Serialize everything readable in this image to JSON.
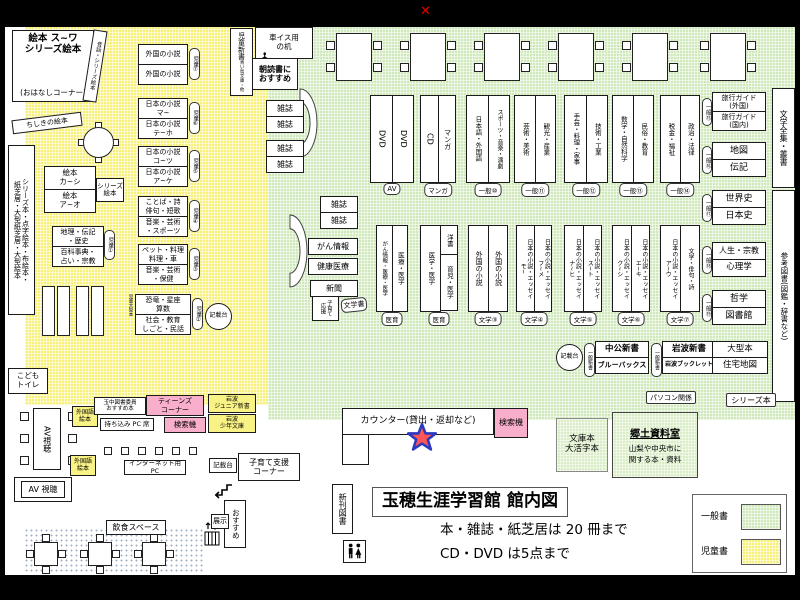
{
  "chrome": {
    "close_mark": "✕"
  },
  "labels": {
    "kisaidai": "記載台",
    "kensakuki": "検索機",
    "zasshi": "雑誌"
  },
  "children_area": {
    "story_room_line1": "絵本 ス~ワ",
    "story_room_line2": "シリーズ絵本",
    "story_room_line3": "(おはなしコーナー)",
    "mukashi_shelf": "昔話・シリーズ絵本",
    "chishiki_shelf": "ちしきの絵本",
    "left_shelf": "シリーズ本・点字絵本・布絵本・\n紙芝居・大型紙芝居・大型絵本",
    "ehon_top": "絵本\nカ~シ",
    "ehon_bottom": "絵本\nア~オ",
    "ehon_series": "シリーズ\n絵本",
    "geo_top": "地理・伝記\n・歴史",
    "geo_bottom": "百科事典・\n占い・宗教",
    "geo_tag": "児童①",
    "side_label": "児童大型本",
    "jido_shinsho": "児童新書",
    "jido_shinsho_sub": "青い鳥文庫・他",
    "asadoku": "朝読書に\nおすすめ",
    "toilet": "こども\nトイレ",
    "shelves": [
      {
        "top": "外国の小説",
        "bottom": "外国の小説",
        "tag": "児童⑦"
      },
      {
        "top": "日本の小説\nマ~",
        "bottom": "日本の小説\nテ~ホ",
        "tag": "児童⑥"
      },
      {
        "top": "日本の小説\nコ~ツ",
        "bottom": "日本の小説\nア~ケ",
        "tag": "児童⑤"
      },
      {
        "top": "ことば・詩\n俳句・短歌",
        "bottom": "音楽・芸術\n・スポーツ",
        "tag": "児童④"
      },
      {
        "top": "ペット・料理\n料理・車",
        "bottom": "音楽・芸術\n・保健",
        "tag": "児童③"
      },
      {
        "top": "恐竜・星座\n算数",
        "bottom": "社会・教育\nしごと・民話",
        "tag": "児童②"
      }
    ]
  },
  "general_area": {
    "wheelchair_desk": "車イス用\nの机",
    "gan": "がん情報",
    "kenko": "健康医療",
    "shinbun": "新聞",
    "kosodate": "子育て\n応援",
    "bungakusho_tag": "文学書",
    "row1": [
      {
        "cols": [
          "DVD",
          "DVD"
        ],
        "tag": "AV"
      },
      {
        "cols": [
          "CD",
          "マンガ"
        ],
        "tag": "マンガ"
      },
      {
        "cols": [
          "日本語・外国語",
          "スポーツ・音楽・演劇"
        ],
        "tag": "一般⑩"
      },
      {
        "cols": [
          "芸術・美術",
          "観光・産業"
        ],
        "tag": "一般⑪"
      },
      {
        "cols": [
          "手芸・料理・家事",
          "技術・工業"
        ],
        "tag": "一般⑫"
      },
      {
        "cols": [
          "数学・自然科学",
          "民俗・教育"
        ],
        "tag": "一般⑬"
      },
      {
        "cols": [
          "税金・福祉",
          "政治・法律"
        ],
        "tag": "一般⑭"
      }
    ],
    "row2": [
      {
        "cols": [
          "がん情報・医療・医学",
          "医療・医学"
        ],
        "tag": "医育"
      },
      {
        "cols": [
          "医学・医学",
          "洋書",
          "育児・医学"
        ],
        "tag": "医育"
      },
      {
        "cols": [
          "外国の小説",
          "外国の小説"
        ],
        "tag": "文学③"
      },
      {
        "cols": [
          "日本の小説・エッセイ\nモ~",
          "日本の小説・エッセイ\nフ~メ"
        ],
        "tag": "文学④"
      },
      {
        "cols": [
          "日本の小説・エッセイ\nナ~ヒ",
          "日本の小説・エッセイ\nス~ト"
        ],
        "tag": "文学⑤"
      },
      {
        "cols": [
          "日本の小説・エッセイ\nク~シ",
          "日本の小説・エッセイ\nエ~キ"
        ],
        "tag": "文学⑥"
      },
      {
        "cols": [
          "日本の小説・エッセイ\nア~ウ",
          "文学・俳句・詩"
        ],
        "tag": "文学⑦"
      }
    ],
    "shinsho": {
      "tag": "一般新書",
      "chuko": "中公新書",
      "bluebacks": "ブルーバックス",
      "iwanami": "岩波新書",
      "booklet": "岩波ブックレット"
    },
    "pc_tag": "パソコン関係",
    "series_tag": "シリーズ本"
  },
  "right_column": {
    "strip_top": "文学全集・叢書",
    "strip_bottom": "参考図書(図鑑・辞書など)",
    "pairs": [
      {
        "top": "旅行ガイド\n(外国)",
        "bottom": "旅行ガイド\n(国内)",
        "tag": "一般⑮"
      },
      {
        "top": "地図",
        "bottom": "伝記",
        "tag": "一般⑯"
      },
      {
        "top": "世界史",
        "bottom": "日本史",
        "tag": "一般⑰"
      },
      {
        "top": "人生・宗教",
        "bottom": "心理学",
        "tag": "一般⑱"
      },
      {
        "top": "哲学",
        "bottom": "図書館",
        "tag": "一般⑲"
      },
      {
        "top": "大型本",
        "bottom": "住宅地図",
        "tag": ""
      }
    ]
  },
  "counter": {
    "label": "カウンター(貸出・返却など)"
  },
  "south_area": {
    "shinkan": "新刊図書",
    "bunko": "文庫本\n大活字本",
    "kyodo_title": "郷土資料室",
    "kyodo_sub": "山梨や中央市に\n関する本・資料",
    "av_table": "AV視聴",
    "av_room": "AV 視聴",
    "gaikokugo_ehon": "外国語\n絵本",
    "tamachu": "玉中図書委員\nおすすめ本",
    "pc_seat": "持ち込み PC 席",
    "teens": "ティーンズ\nコーナー",
    "iwanami_junior": "岩波\nジュニア新書",
    "iwanami_shonen": "岩波\n少年文庫",
    "internet_pc": "インターネット用 PC",
    "kosodate_shien": "子育て支援\nコーナー",
    "osusume": "おすすめ",
    "tenji": "展示",
    "inshoku": "飲食スペース"
  },
  "title_block": {
    "title": "玉穂生涯学習館 館内図",
    "note1": "本・雑誌・紙芝居は 20 冊まで",
    "note2": "CD・DVD は5点まで"
  },
  "legend": {
    "general": "一般書",
    "children": "児童書"
  },
  "colors": {
    "general_area": "#cfe9bb",
    "children_area": "#f7f07a",
    "search_pink": "#f9aecb",
    "star_fill": "#ff5555",
    "star_stroke": "#2b39c0"
  }
}
